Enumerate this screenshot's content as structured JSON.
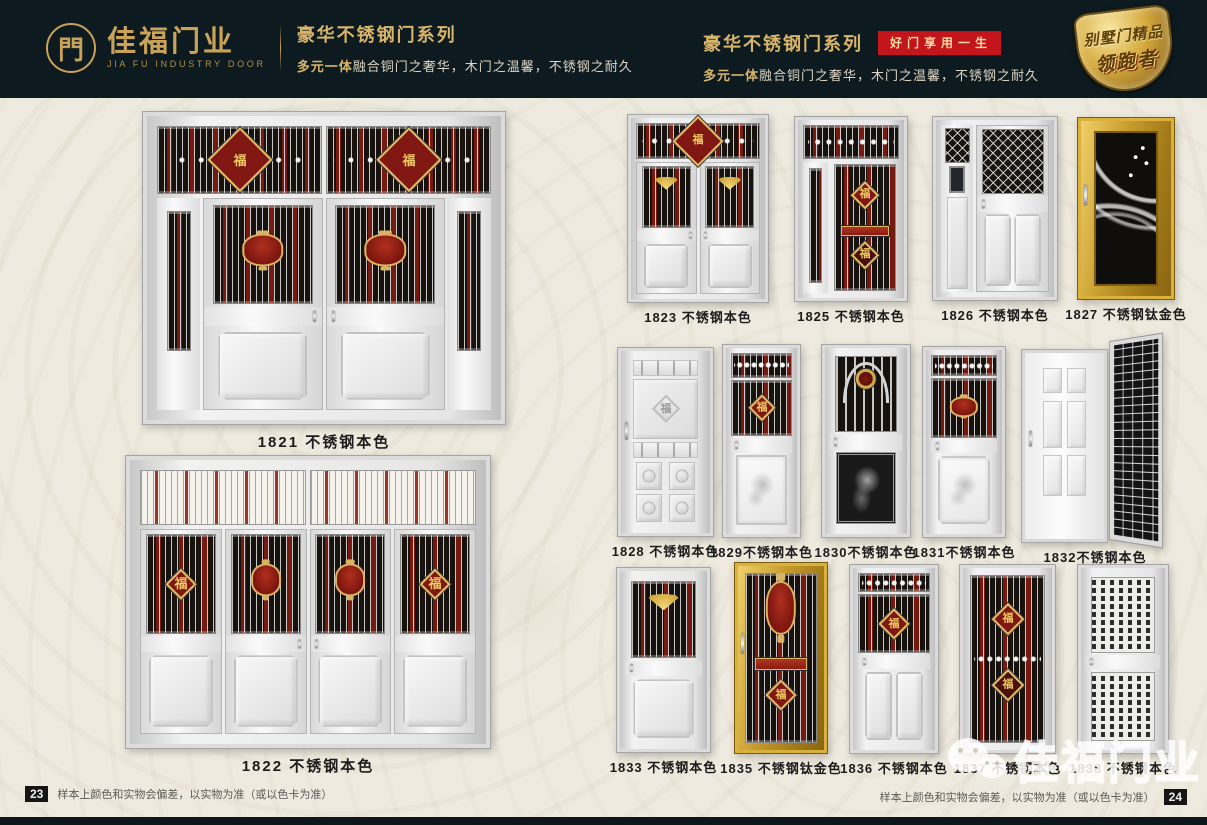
{
  "header": {
    "logo": {
      "symbol": "門",
      "brand_cn": "佳福门业",
      "brand_en": "JIA FU INDUSTRY DOOR"
    },
    "left": {
      "series_title": "豪华不锈钢门系列",
      "subtitle_em": "多元一体",
      "subtitle_rest": "融合铜门之奢华，木门之温馨，不锈钢之耐久"
    },
    "right": {
      "series_title": "豪华不锈钢门系列",
      "badge": "好门享用一生",
      "subtitle_em": "多元一体",
      "subtitle_rest": "融合铜门之奢华，木门之温馨，不锈钢之耐久"
    },
    "shield": {
      "line1": "别墅门精品",
      "line2": "领跑者"
    }
  },
  "glyphs": {
    "fu": "福"
  },
  "colors": {
    "header_bg": "#0d1b20",
    "gold": "#c9a258",
    "badge_red": "#c4151c",
    "page_bg": "#eeeadf",
    "grille_red": "#8b1c10",
    "titanium_gold": "#c79d2e"
  },
  "products": [
    {
      "model": "1821",
      "label": "1821 不锈钢本色",
      "finish": "不锈钢本色",
      "style": "grand-double",
      "page": "left"
    },
    {
      "model": "1822",
      "label": "1822 不锈钢本色",
      "finish": "不锈钢本色",
      "style": "grand-quad",
      "page": "left"
    },
    {
      "model": "1823",
      "label": "1823 不锈钢本色",
      "finish": "不锈钢本色",
      "style": "double-fan",
      "page": "right"
    },
    {
      "model": "1825",
      "label": "1825 不锈钢本色",
      "finish": "不锈钢本色",
      "style": "mother-son-grille",
      "page": "right"
    },
    {
      "model": "1826",
      "label": "1826 不锈钢本色",
      "finish": "不锈钢本色",
      "style": "mother-son-grid",
      "page": "right"
    },
    {
      "model": "1827",
      "label": "1827 不锈钢钛金色",
      "finish": "不锈钢钛金色",
      "style": "gold-ornate",
      "page": "right"
    },
    {
      "model": "1828",
      "label": "1828 不锈钢本色",
      "finish": "不锈钢本色",
      "style": "steel-emboss",
      "page": "right"
    },
    {
      "model": "1829",
      "label": "1829不锈钢本色",
      "finish": "不锈钢本色",
      "style": "grille-etch",
      "page": "right"
    },
    {
      "model": "1830",
      "label": "1830不锈钢本色",
      "finish": "不锈钢本色",
      "style": "arch-grille",
      "page": "right"
    },
    {
      "model": "1831",
      "label": "1831不锈钢本色",
      "finish": "不锈钢本色",
      "style": "lantern-grille",
      "page": "right"
    },
    {
      "model": "1832",
      "label": "1832不锈钢本色",
      "finish": "不锈钢本色",
      "style": "six-panel-open",
      "page": "right"
    },
    {
      "model": "1833",
      "label": "1833 不锈钢本色",
      "finish": "不锈钢本色",
      "style": "fan-grille",
      "page": "right"
    },
    {
      "model": "1835",
      "label": "1835 不锈钢钛金色",
      "finish": "不锈钢钛金色",
      "style": "gold-grille",
      "page": "right"
    },
    {
      "model": "1836",
      "label": "1836 不锈钢本色",
      "finish": "不锈钢本色",
      "style": "diamond-grille",
      "page": "right"
    },
    {
      "model": "1837",
      "label": "1837 不锈钢本色",
      "finish": "不锈钢本色",
      "style": "double-diamond-grille",
      "page": "right"
    },
    {
      "model": "1838",
      "label": "1838 不锈钢本色",
      "finish": "不锈钢本色",
      "style": "perforated",
      "page": "right"
    }
  ],
  "footer": {
    "left_page_no": "23",
    "right_page_no": "24",
    "disclaimer": "样本上颜色和实物会偏差，以实物为准（或以色卡为准）"
  },
  "watermark": {
    "text": "佳福门业",
    "icon": "wechat-icon"
  }
}
